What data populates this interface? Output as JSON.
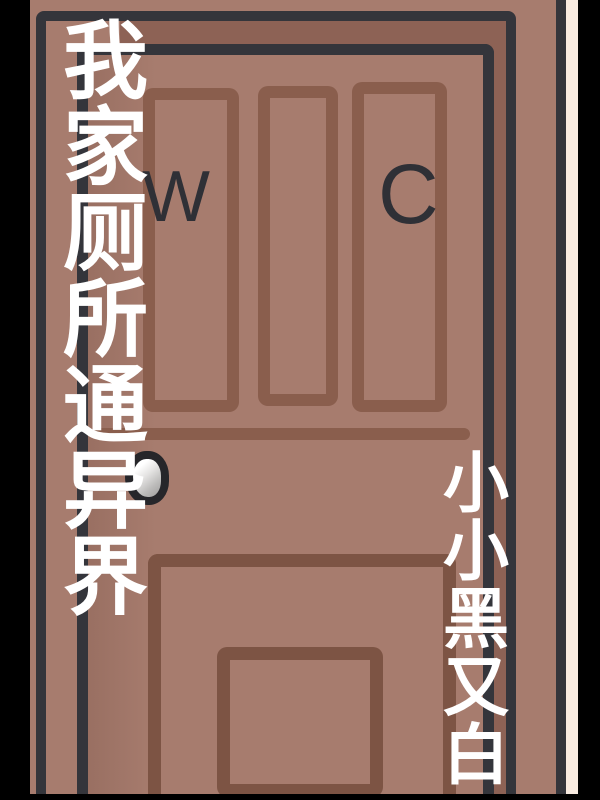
{
  "cover": {
    "title": "我家厕所通异界",
    "author": "小小黑又白",
    "door_sign": {
      "left_letter": "W",
      "right_letter": "C"
    }
  },
  "colors": {
    "background_black": "#000000",
    "wall_strip_cream": "#f8ebe0",
    "door_face_brown": "#a77c6e",
    "door_jamb_brown": "#8d6255",
    "outline_dark_gray": "#34353b",
    "upper_panel_line": "#8a5e4d",
    "lower_panel_line": "#7d5444",
    "title_text": "#ffffff",
    "sign_text": "#2f3036",
    "knob_outline": "#26262a",
    "knob_highlight": "#ffffff",
    "knob_shadow": "#a2a1a0"
  }
}
